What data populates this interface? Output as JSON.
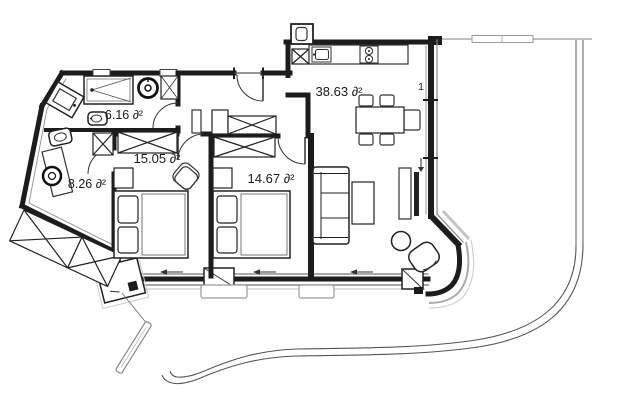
{
  "plan": {
    "title": "apartment-floor-plan",
    "unit_suffix": "∂²",
    "rooms": [
      {
        "id": "bathroom",
        "area_label": "6.16 ∂²"
      },
      {
        "id": "hall-wc",
        "area_label": "8.26 ∂²"
      },
      {
        "id": "bedroom-1",
        "area_label": "15.05 ∂²"
      },
      {
        "id": "bedroom-2",
        "area_label": "14.67 ∂²"
      },
      {
        "id": "living-kitchen",
        "area_label": "38.63 ∂²"
      }
    ],
    "window_tag": "1",
    "colors": {
      "wall": "#1c1c1c",
      "thin_line": "#555555",
      "shadow": "#c0c0c0",
      "site_line": "#8a8a8a",
      "text": "#1a1a1a",
      "background": "#ffffff"
    }
  }
}
